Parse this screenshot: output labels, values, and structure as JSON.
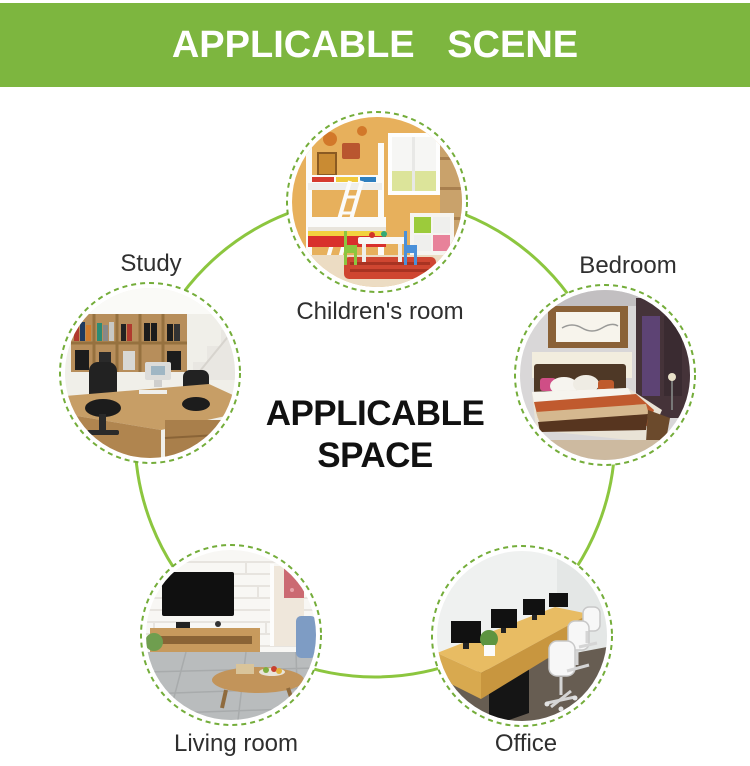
{
  "banner": {
    "title": "APPLICABLE SCENE"
  },
  "center_title": {
    "line1": "APPLICABLE",
    "line2": "SPACE"
  },
  "nodes": [
    {
      "id": "children-room",
      "label": "Children's room"
    },
    {
      "id": "study",
      "label": "Study"
    },
    {
      "id": "bedroom",
      "label": "Bedroom"
    },
    {
      "id": "living-room",
      "label": "Living room"
    },
    {
      "id": "office",
      "label": "Office"
    }
  ],
  "icons": [
    "children-room-photo-icon",
    "study-photo-icon",
    "bedroom-photo-icon",
    "living-room-photo-icon",
    "office-photo-icon"
  ],
  "colors": {
    "banner_green": "#7db63f",
    "ring_green": "#8cc63f",
    "dash_green": "#74ad3a",
    "label_text": "#2f2f2f",
    "banner_text": "#ffffff",
    "center_text": "#111111"
  }
}
